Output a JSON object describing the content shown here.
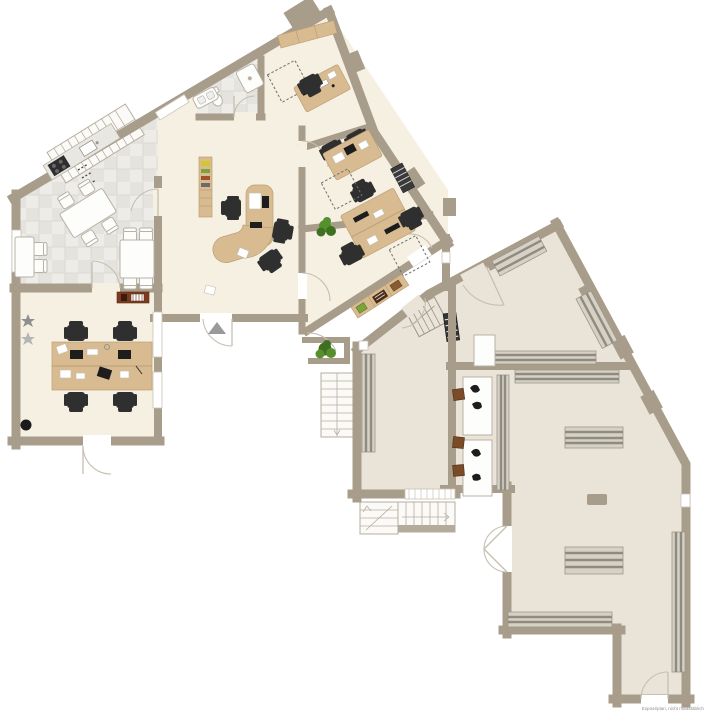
{
  "annotation": {
    "disclaimer": "Exposéplan, nicht maßstäblich"
  },
  "colors": {
    "wall": "#a89c8a",
    "floor_office": "#f5f0e1",
    "floor_hall": "#e9e3d8",
    "wood": "#d8bb91",
    "wood_edge": "#bd9f74",
    "sideboard": "#7c3a20",
    "shelf": "#d5d1c5",
    "shelf_stripe": "#8f8b80",
    "chair": "#2f2f2f",
    "stool": "#7b4b28",
    "plant": "#55902c",
    "plant_dark": "#3f7021"
  },
  "icons": [
    "entrance-arrow-icon",
    "door-swing-icon",
    "stairs-icon",
    "plant-icon",
    "star-decoration-icon",
    "toilet-icon",
    "shower-icon",
    "sink-icon",
    "stove-icon",
    "desk-icon",
    "office-chair-icon",
    "shelf-rack-icon"
  ],
  "features": {
    "unit_left": [
      "kitchen",
      "bathroom",
      "meeting-room",
      "office-rooms",
      "team-room"
    ],
    "unit_right": [
      "storage-hall-upper",
      "storage-hall-lower",
      "workbench-area"
    ]
  }
}
